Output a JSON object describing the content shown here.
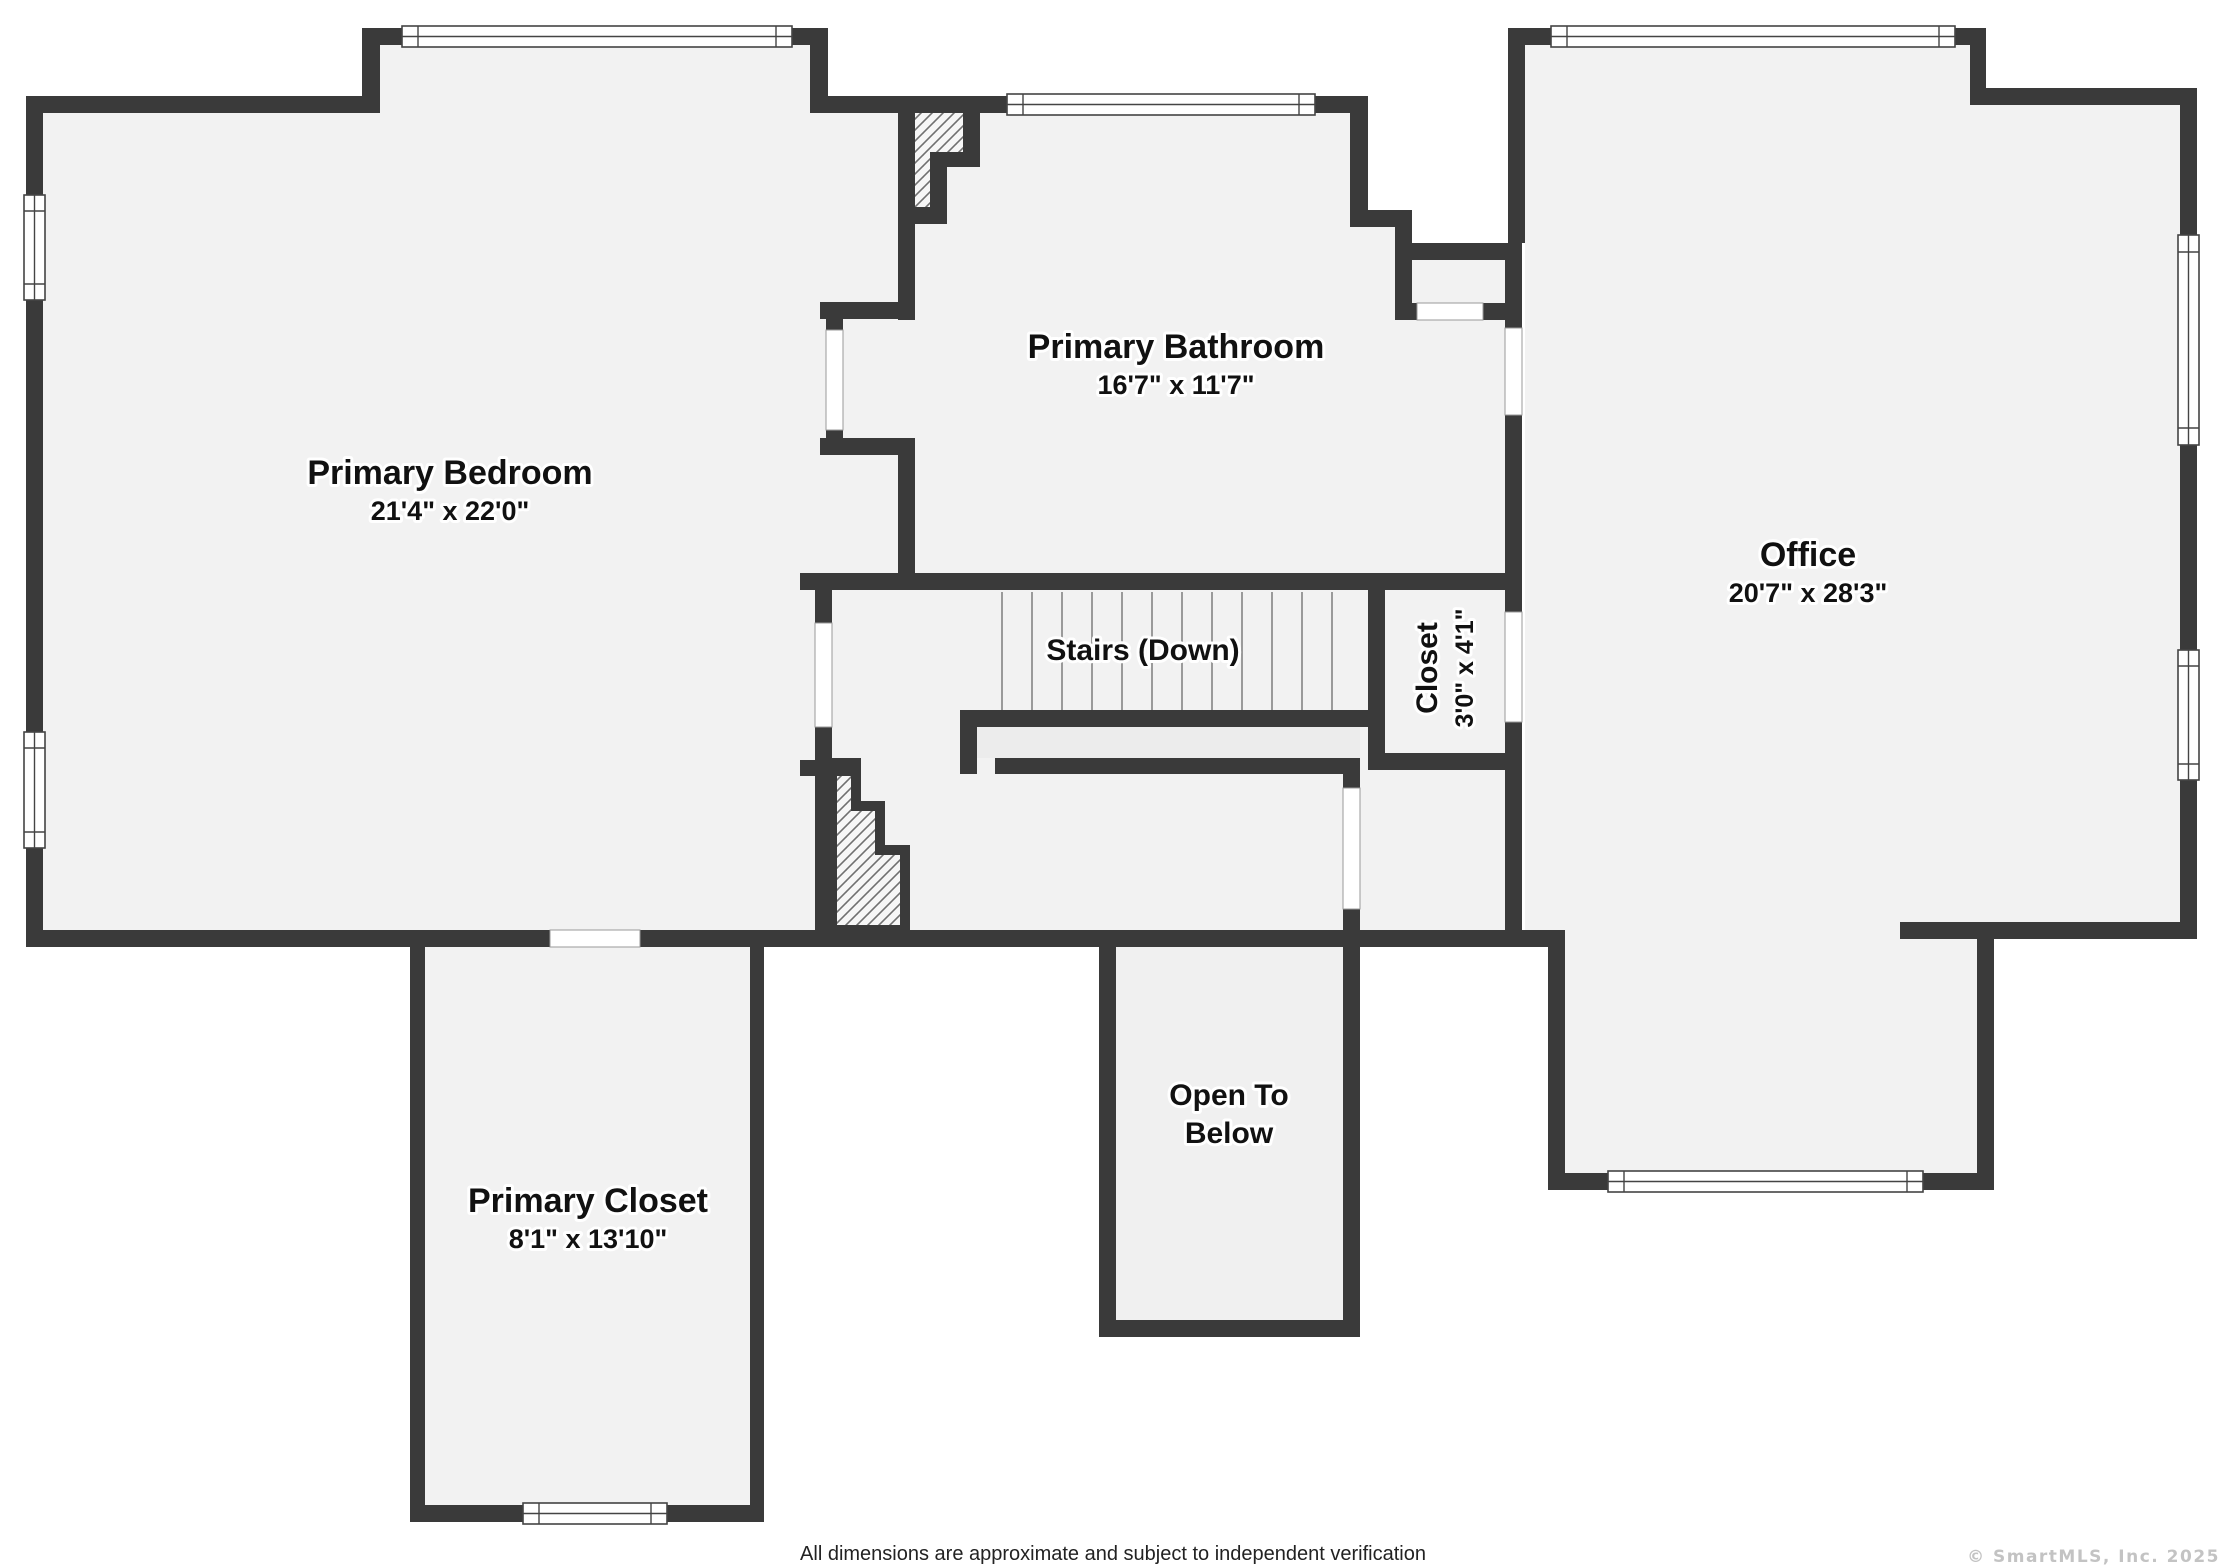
{
  "floorplan": {
    "rooms": {
      "primary_bedroom": {
        "name": "Primary Bedroom",
        "dims": "21'4\" x 22'0\""
      },
      "primary_bathroom": {
        "name": "Primary Bathroom",
        "dims": "16'7\" x 11'7\""
      },
      "office": {
        "name": "Office",
        "dims": "20'7\" x 28'3\""
      },
      "primary_closet": {
        "name": "Primary Closet",
        "dims": "8'1\" x 13'10\""
      },
      "closet": {
        "name": "Closet",
        "dims": "3'0\" x 4'1\""
      },
      "stairs": {
        "label": "Stairs (Down)"
      },
      "open_to_below": {
        "line1": "Open To",
        "line2": "Below"
      }
    },
    "footer": {
      "disclaimer": "All dimensions are approximate and subject to independent verification"
    },
    "watermark": {
      "text": "© SmartMLS, Inc.  2025"
    },
    "colors": {
      "wall": "#3a3a3a",
      "floor": "#f2f2f2",
      "background": "#ffffff",
      "watermark": "#c3c3c3"
    }
  }
}
